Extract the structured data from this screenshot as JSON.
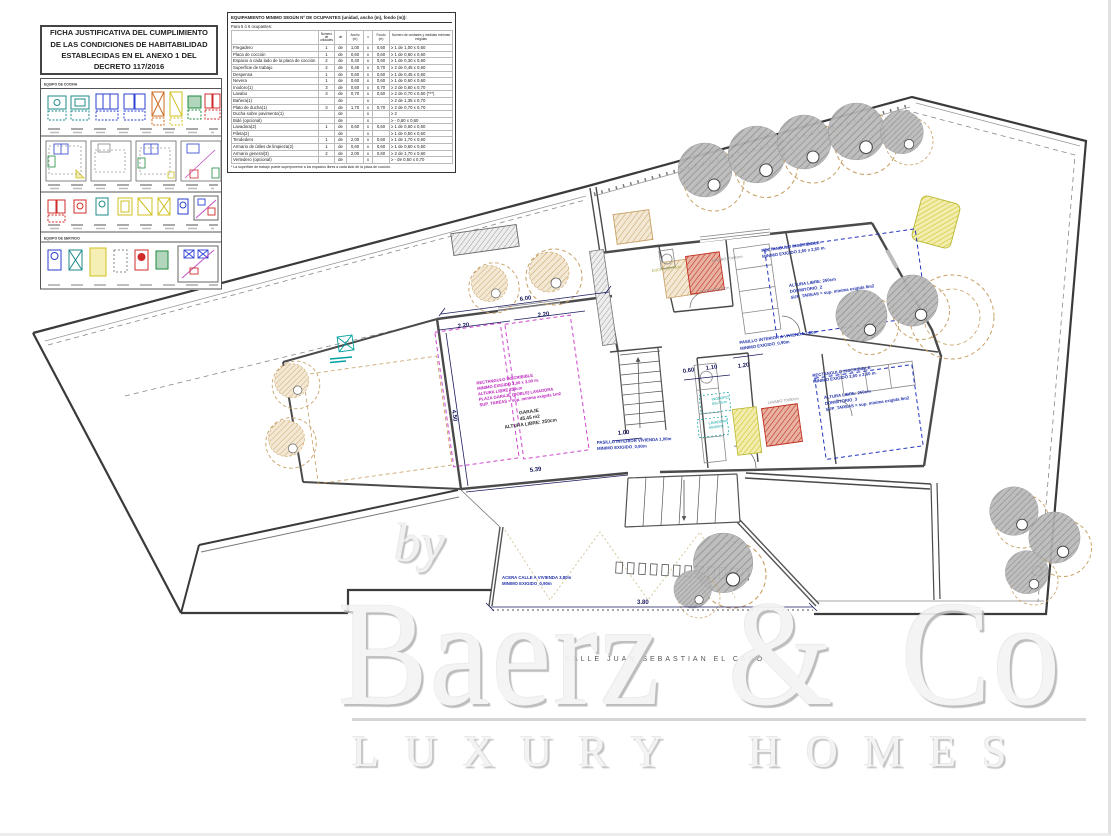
{
  "title_block": {
    "text": "FICHA JUSTIFICATIVA DEL CUMPLIMIENTO DE LAS CONDICIONES DE HABITABILIDAD ESTABLECIDAS EN EL ANEXO 1 DEL DECRETO 117/2016"
  },
  "legend": {
    "header_kitchen": "EQUIPO DE COCINA",
    "header_service": "EQUIPO DE SERVICIO"
  },
  "equipment_table": {
    "title": "EQUIPAMIENTO MINIMO SEGÚN Nº DE OCUPANTES (unidad, ancho (m), fondo (m)):",
    "subtitle": "Para 5 ó 6 ocupantes:",
    "col_headers": [
      "Número de unidades",
      "de",
      "Ancho (m)",
      "x",
      "Fondo (m)",
      "Número de unidades y medidas mínimas exigidas"
    ],
    "rows": [
      {
        "name": "Fregadero",
        "num": "1",
        "de": "de",
        "ancho": "1,00",
        "x": "x",
        "fondo": "0,60",
        "req": "≥  1 de 1,00 x 0,60"
      },
      {
        "name": "Placa de cocción",
        "num": "1",
        "de": "de",
        "ancho": "0,60",
        "x": "x",
        "fondo": "0,60",
        "req": "≥  1 de 0,60 x 0,60"
      },
      {
        "name": "Espacio a cada lado de la placa de cocción",
        "num": "2",
        "de": "de",
        "ancho": "0,40",
        "x": "x",
        "fondo": "0,60",
        "req": "≥  1 de 0,30 x 0,60"
      },
      {
        "name": "Superficie de trabajo",
        "num": "2",
        "de": "de",
        "ancho": "0,45",
        "x": "x",
        "fondo": "0,70",
        "req": "≥  2 de 0,45 x 0,60"
      },
      {
        "name": "Despensa",
        "num": "1",
        "de": "de",
        "ancho": "0,60",
        "x": "x",
        "fondo": "0,60",
        "req": "≥  1 de 0,45 x 0,60"
      },
      {
        "name": "Nevera",
        "num": "1",
        "de": "de",
        "ancho": "0,60",
        "x": "x",
        "fondo": "0,60",
        "req": "≥  1 de 0,60 x 0,60"
      },
      {
        "name": "Inodoro(1)",
        "num": "3",
        "de": "de",
        "ancho": "0,60",
        "x": "x",
        "fondo": "0,70",
        "req": "≥  2 de 0,60 x 0,70"
      },
      {
        "name": "Lavabo",
        "num": "3",
        "de": "de",
        "ancho": "0,70",
        "x": "x",
        "fondo": "0,50",
        "req": "≥  2 de 0,70 x 0,50 (***)"
      },
      {
        "name": "Bañera(1)",
        "num": "",
        "de": "de",
        "ancho": "",
        "x": "x",
        "fondo": "",
        "req": "≥  2 de 1,35 x 0,70"
      },
      {
        "name": "Plato de ducha(1)",
        "num": "3",
        "de": "de",
        "ancho": "1,70",
        "x": "x",
        "fondo": "0,70",
        "req": "≥  2 de 0,70 x 0,70"
      },
      {
        "name": "Ducha sobre pavimento(1)",
        "num": "",
        "de": "de",
        "ancho": "",
        "x": "x",
        "fondo": "",
        "req": "≥  2"
      },
      {
        "name": "Bidé (opcional)",
        "num": "",
        "de": "de",
        "ancho": "",
        "x": "x",
        "fondo": "",
        "req": "≥  -  0,60 x 0,60"
      },
      {
        "name": "Lavadora(2)",
        "num": "1",
        "de": "de",
        "ancho": "0,60",
        "x": "x",
        "fondo": "0,60",
        "req": "≥  1 de 0,60 x 0,60"
      },
      {
        "name": "Pileta(2)",
        "num": "",
        "de": "de",
        "ancho": "",
        "x": "x",
        "fondo": "",
        "req": "≥  1 de 0,50 x 0,60"
      },
      {
        "name": "Tendedero",
        "num": "1",
        "de": "de",
        "ancho": "2,00",
        "x": "x",
        "fondo": "0,60",
        "req": "≥  1 de 1,70 x 0,60"
      },
      {
        "name": "Armario de útiles de limpieza(2)",
        "num": "1",
        "de": "de",
        "ancho": "0,60",
        "x": "x",
        "fondo": "0,60",
        "req": "≥  1 de 0,60 x 0,60"
      },
      {
        "name": "Armario general(3)",
        "num": "2",
        "de": "de",
        "ancho": "2,00",
        "x": "x",
        "fondo": "0,60",
        "req": "≥  2 de 1,70 x 0,60"
      },
      {
        "name": "Vertedero (opcional)",
        "num": "",
        "de": "de",
        "ancho": "",
        "x": "x",
        "fondo": "",
        "req": "≥  -  de 0,50 x 0,70"
      }
    ],
    "footnote": "* La superficie de trabajo puede superponerse a los espacios libres a cada lado de la placa de cocción."
  },
  "plan": {
    "dimensions": {
      "garage_width": "6.00",
      "bay_left": "2.20",
      "bay_right": "2.20",
      "garage_depth": "4.50",
      "garage_bottom": "5.39",
      "hall_width": "1.20",
      "bath_a": "0.60",
      "bath_b": "1.10",
      "hall2_width": "1.00",
      "entry_width": "3.80"
    },
    "annotations": {
      "dorm2_rect": [
        "RECTANGULO INSCRIBIBLE",
        "MINIMO EXIGIDO 2,60 x 2,60 m."
      ],
      "dorm2": [
        "ALTURA LIBRE: 250cm",
        "DORMITORIO_2",
        "SUP_TAREAS = sup. minima exigida 8m2"
      ],
      "dorm3_rect": [
        "RECTANGULO INSCRIBIBLE",
        "MINIMO EXIGIDO 2,60 x 2,60 m."
      ],
      "dorm3": [
        "ALTURA LIBRE: 250cm",
        "DORMITORIO_3",
        "SUP_TAREAS = sup. minima exigida 8m2"
      ],
      "garage_rect": [
        "RECTANGULO INSCRIBIBLE",
        "MINIMO EXIGIDO 3,00 x 3,00 m.",
        "ALTURA LIBRE 250cm",
        "PLAZA GARAJE (DOBLE) LAVADORA",
        "SUP_TAREAS > sup. minima exigida 1m2"
      ],
      "garage": [
        "GARAJE",
        "45,45 m2",
        "ALTURA LIBRE: 250cm"
      ],
      "hall1": [
        "PASILLO INTERIOR A VIVIENDA 1,20m",
        "MINIMO EXIGIDO_0,90m"
      ],
      "hall2": [
        "PASILLO INTERIOR VIVIENDA 1,00m",
        "MINIMO EXIGIDO_0,90m"
      ],
      "entry": [
        "ACERA CALLE A VIVIENDA 3,80m",
        "MINIMO EXIGIDO_0,90m"
      ],
      "lavabo1": "LAVABO 70x50cm",
      "lavabo2": "LAVABO 70x50cm",
      "ducha1": "DUCHA 70x70cm",
      "ducha2": "DUCHA 70x70cm",
      "inodoro": [
        "INODORO",
        "60x70cm"
      ],
      "lavadora": [
        "LAVADORA",
        "60x60cm"
      ]
    },
    "street_label": "CALLE  JUAN  SEBASTIAN  EL  CANO"
  },
  "watermark": {
    "prefix": "by",
    "brand": "Baerz & Co",
    "tagline": "LUXURY HOMES"
  },
  "colors": {
    "wall": "#4a4a4a",
    "boundary": "#3a3a3a",
    "annotation_blue": "#2233aa",
    "annotation_magenta": "#bb22bb",
    "annotation_cyan": "#00a0a0",
    "tree_gray": "#8a8a8a",
    "tree_tan": "#c79f62",
    "hatch_red": "#c03020",
    "hatch_yellow": "#cfc529",
    "watermark_gray": "#d2d2d2"
  }
}
